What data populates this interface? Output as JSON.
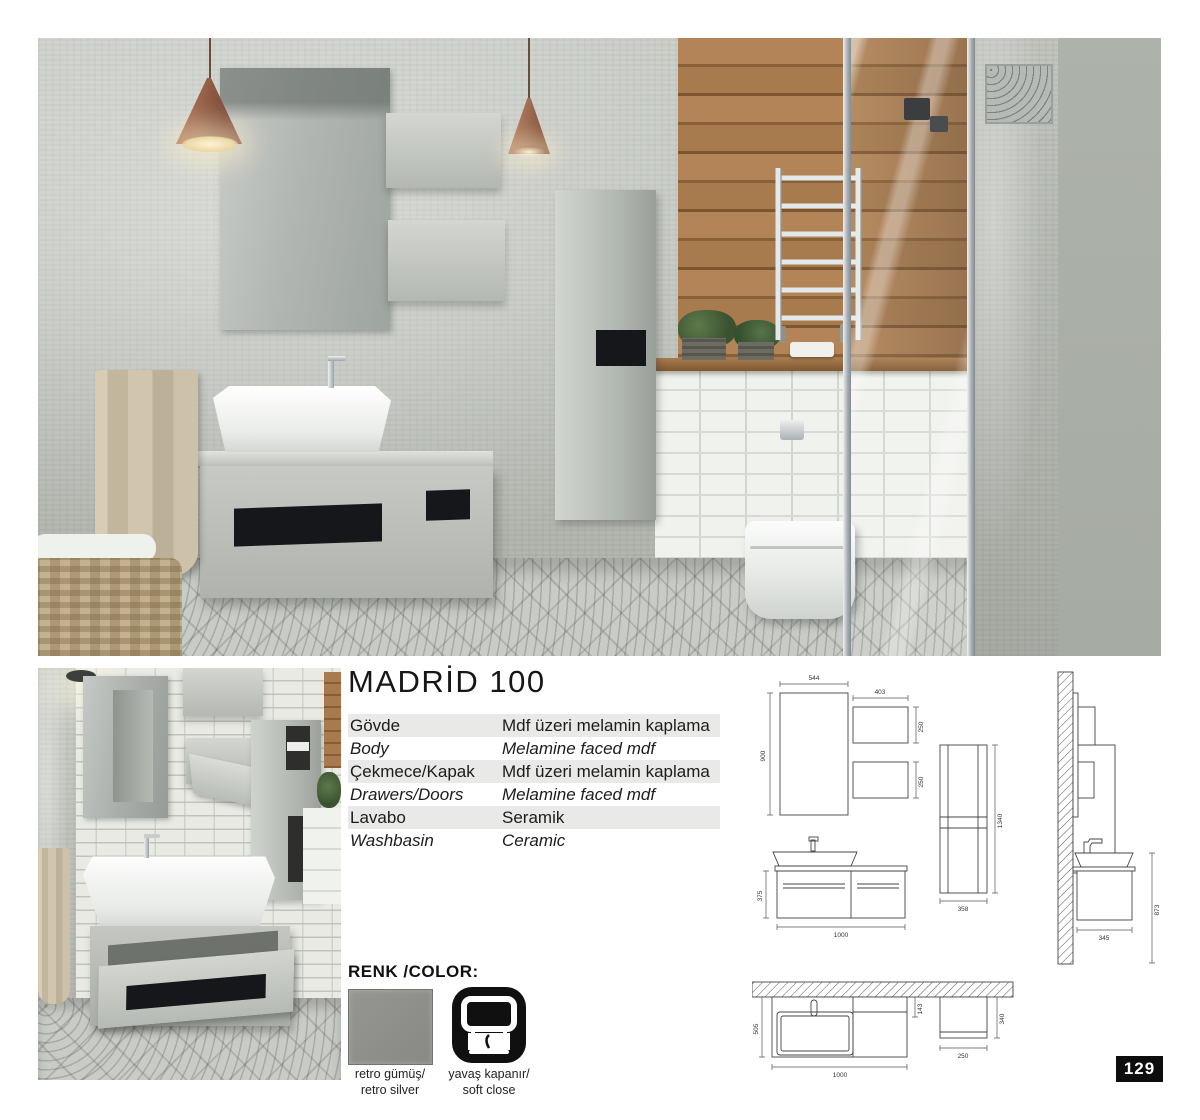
{
  "title": "MADRİD 100",
  "page_number": "129",
  "specs": {
    "rows": [
      {
        "label": "Gövde",
        "value": "Mdf üzeri melamin kaplama"
      },
      {
        "label": "Body",
        "value": "Melamine faced mdf"
      },
      {
        "label": "Çekmece/Kapak",
        "value": "Mdf üzeri melamin kaplama"
      },
      {
        "label": "Drawers/Doors",
        "value": "Melamine faced mdf"
      },
      {
        "label": "Lavabo",
        "value": "Seramik"
      },
      {
        "label": "Washbasin",
        "value": "Ceramic"
      }
    ]
  },
  "color_section": {
    "heading": "RENK /COLOR:",
    "swatch_hex": "#8f908c",
    "swatch_caption_line1": "retro gümüş/",
    "swatch_caption_line2": "retro silver",
    "feature_icon": "soft-close-icon",
    "feature_caption_line1": "yavaş kapanır/",
    "feature_caption_line2": "soft close"
  },
  "drawings": {
    "mirror": {
      "w": "544",
      "h": "900"
    },
    "wall_cabinet": {
      "w": "403",
      "h_top": "250",
      "h_bottom": "250"
    },
    "tall_cabinet": {
      "h": "1340",
      "w": "358"
    },
    "vanity_front": {
      "h": "375",
      "w": "1000"
    },
    "side_view": {
      "d": "345",
      "h": "873"
    },
    "plan_view": {
      "depth": "505",
      "gap": "143",
      "w": "1000",
      "cabinet_w": "250",
      "cabinet_d": "340"
    }
  }
}
